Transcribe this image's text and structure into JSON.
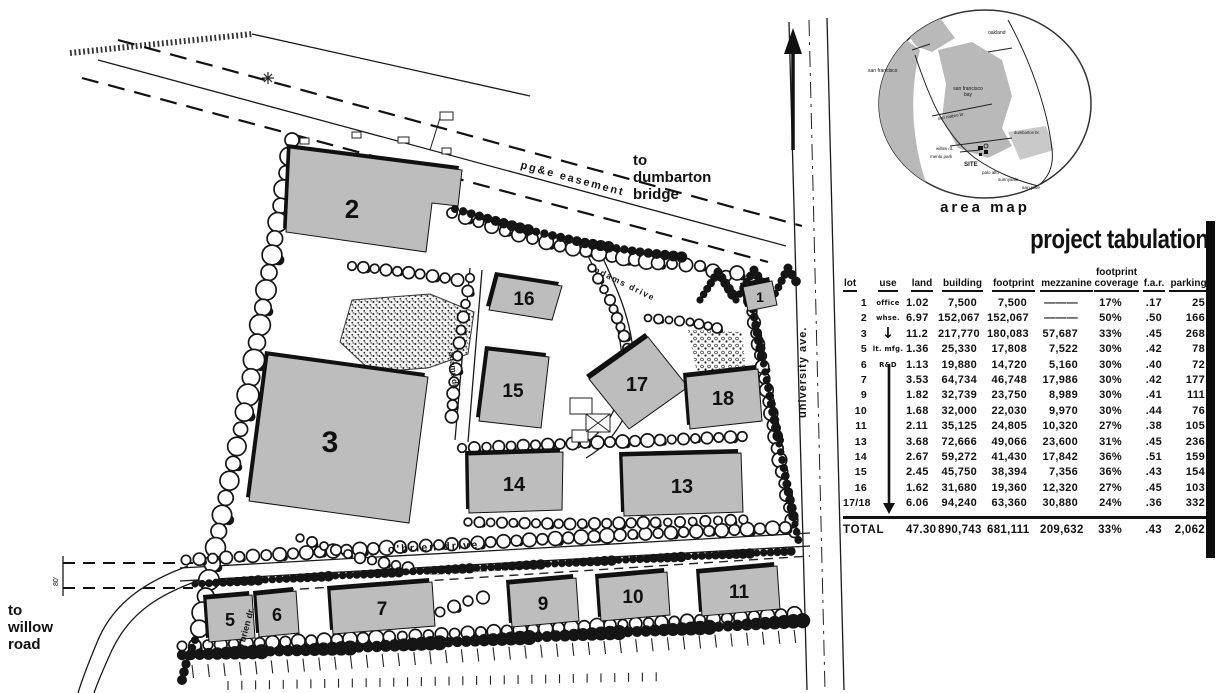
{
  "colors": {
    "ink": "#111111",
    "building_fill": "#bdbdbd",
    "building_stroke": "#1a1a1a",
    "map_land": "#b9b9b9",
    "paper": "#ffffff"
  },
  "site_plan": {
    "street_labels": {
      "pgae_easement": "pg&e easement",
      "obrien_drive": "o'brien drive",
      "obrien_dr": "o'brien dr.",
      "adams_drive": "adams drive",
      "adams_dr": "adams dr.",
      "university_ave": "university ave.",
      "water_easement": "existing san francisco water easement",
      "dim_80": "80'"
    },
    "direction_labels": {
      "to_dumbarton": "to\ndumbarton\nbridge",
      "to_willow": "to\nwillow\nroad"
    },
    "buildings": [
      {
        "id": "1",
        "label": "1"
      },
      {
        "id": "2",
        "label": "2"
      },
      {
        "id": "3",
        "label": "3"
      },
      {
        "id": "5",
        "label": "5"
      },
      {
        "id": "6",
        "label": "6"
      },
      {
        "id": "7",
        "label": "7"
      },
      {
        "id": "9",
        "label": "9"
      },
      {
        "id": "10",
        "label": "10"
      },
      {
        "id": "11",
        "label": "11"
      },
      {
        "id": "13",
        "label": "13"
      },
      {
        "id": "14",
        "label": "14"
      },
      {
        "id": "15",
        "label": "15"
      },
      {
        "id": "16",
        "label": "16"
      },
      {
        "id": "17",
        "label": "17"
      },
      {
        "id": "18",
        "label": "18"
      }
    ]
  },
  "area_map": {
    "caption": "area map",
    "labels": [
      {
        "id": "oakland",
        "text": "oakland"
      },
      {
        "id": "san-francisco",
        "text": "san francisco"
      },
      {
        "id": "san-francisco-bay",
        "text": "san francisco\nbay"
      },
      {
        "id": "san-mateo-br",
        "text": "san mateo br."
      },
      {
        "id": "dumbarton-br",
        "text": "dumbarton br."
      },
      {
        "id": "willow-rd",
        "text": "willow rd."
      },
      {
        "id": "menlo-park",
        "text": "menlo park"
      },
      {
        "id": "site",
        "text": "SITE"
      },
      {
        "id": "palo-alto",
        "text": "palo alto"
      },
      {
        "id": "sunnyvale",
        "text": "sunnyvale"
      },
      {
        "id": "san-jose",
        "text": "san jose"
      }
    ]
  },
  "tabulation": {
    "title": "project tabulation",
    "columns": [
      "lot",
      "use",
      "land",
      "building",
      "footprint",
      "mezzanine",
      "footprint\ncoverage",
      "f.a.r.",
      "parking"
    ],
    "rows": [
      {
        "lot": "1",
        "use": "office",
        "land": "1.02",
        "building": "7,500",
        "footprint": "7,500",
        "mezzanine": "———",
        "coverage": "17%",
        "far": ".17",
        "parking": "25"
      },
      {
        "lot": "2",
        "use": "whse.",
        "land": "6.97",
        "building": "152,067",
        "footprint": "152,067",
        "mezzanine": "———",
        "coverage": "50%",
        "far": ".50",
        "parking": "166"
      },
      {
        "lot": "3",
        "use": "↓",
        "land": "11.2",
        "building": "217,770",
        "footprint": "180,083",
        "mezzanine": "57,687",
        "coverage": "33%",
        "far": ".45",
        "parking": "268"
      },
      {
        "lot": "5",
        "use": "lt. mfg.",
        "land": "1.36",
        "building": "25,330",
        "footprint": "17,808",
        "mezzanine": "7,522",
        "coverage": "30%",
        "far": ".42",
        "parking": "78"
      },
      {
        "lot": "6",
        "use": "R&D",
        "land": "1.13",
        "building": "19,880",
        "footprint": "14,720",
        "mezzanine": "5,160",
        "coverage": "30%",
        "far": ".40",
        "parking": "72"
      },
      {
        "lot": "7",
        "use": "",
        "land": "3.53",
        "building": "64,734",
        "footprint": "46,748",
        "mezzanine": "17,986",
        "coverage": "30%",
        "far": ".42",
        "parking": "177"
      },
      {
        "lot": "9",
        "use": "",
        "land": "1.82",
        "building": "32,739",
        "footprint": "23,750",
        "mezzanine": "8,989",
        "coverage": "30%",
        "far": ".41",
        "parking": "111"
      },
      {
        "lot": "10",
        "use": "",
        "land": "1.68",
        "building": "32,000",
        "footprint": "22,030",
        "mezzanine": "9,970",
        "coverage": "30%",
        "far": ".44",
        "parking": "76"
      },
      {
        "lot": "11",
        "use": "",
        "land": "2.11",
        "building": "35,125",
        "footprint": "24,805",
        "mezzanine": "10,320",
        "coverage": "27%",
        "far": ".38",
        "parking": "105"
      },
      {
        "lot": "13",
        "use": "",
        "land": "3.68",
        "building": "72,666",
        "footprint": "49,066",
        "mezzanine": "23,600",
        "coverage": "31%",
        "far": ".45",
        "parking": "236"
      },
      {
        "lot": "14",
        "use": "",
        "land": "2.67",
        "building": "59,272",
        "footprint": "41,430",
        "mezzanine": "17,842",
        "coverage": "36%",
        "far": ".51",
        "parking": "159"
      },
      {
        "lot": "15",
        "use": "",
        "land": "2.45",
        "building": "45,750",
        "footprint": "38,394",
        "mezzanine": "7,356",
        "coverage": "36%",
        "far": ".43",
        "parking": "154"
      },
      {
        "lot": "16",
        "use": "",
        "land": "1.62",
        "building": "31,680",
        "footprint": "19,360",
        "mezzanine": "12,320",
        "coverage": "27%",
        "far": ".45",
        "parking": "103"
      },
      {
        "lot": "17/18",
        "use": "",
        "land": "6.06",
        "building": "94,240",
        "footprint": "63,360",
        "mezzanine": "30,880",
        "coverage": "24%",
        "far": ".36",
        "parking": "332"
      }
    ],
    "total": {
      "lot": "TOTAL",
      "use": "",
      "land": "47.30",
      "building": "890,743",
      "footprint": "681,111",
      "mezzanine": "209,632",
      "coverage": "33%",
      "far": ".43",
      "parking": "2,062"
    }
  }
}
